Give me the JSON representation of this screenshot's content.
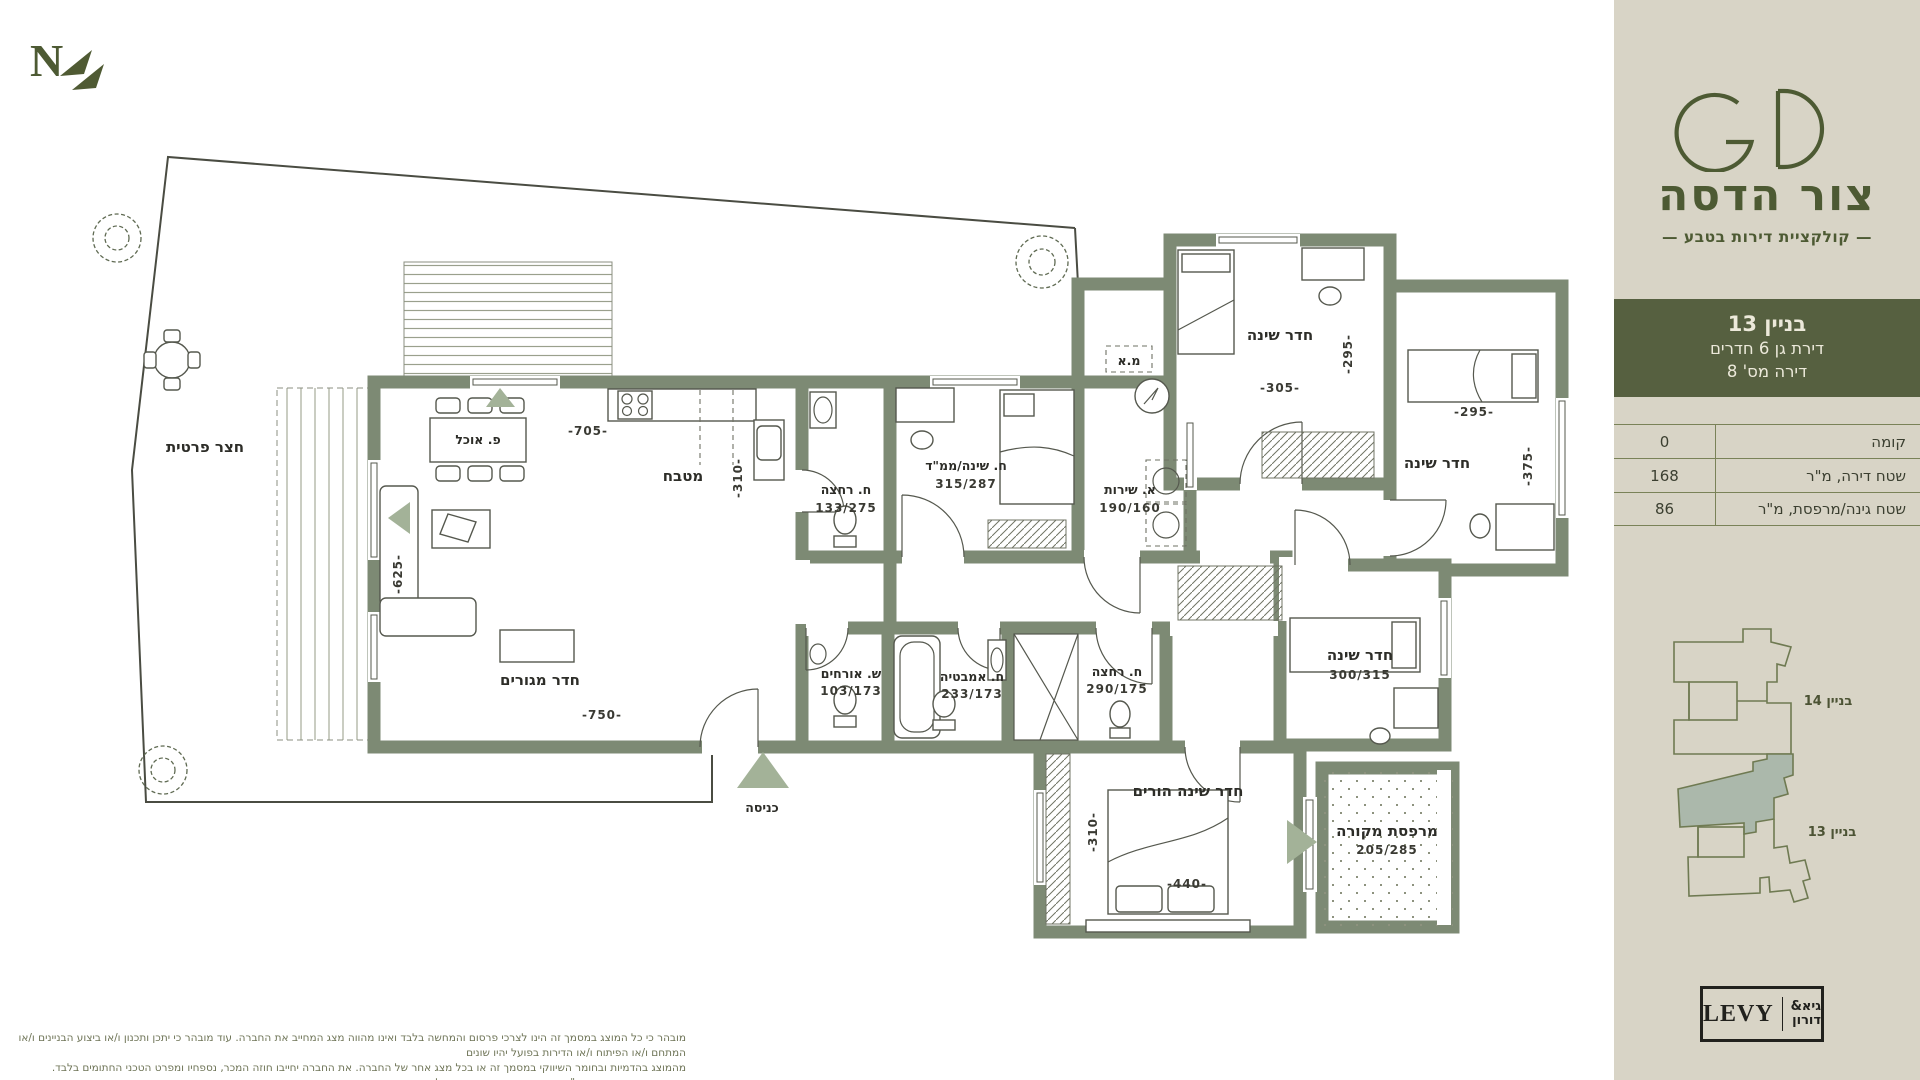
{
  "brand": {
    "logo": "GD",
    "title": "צור הדסה",
    "subtitle": "— קולקציית דירות בטבע —"
  },
  "unit": {
    "building": "בניין 13",
    "type": "דירת גן 6 חדרים",
    "number": "דירה מס' 8"
  },
  "specs": {
    "rows": [
      {
        "label": "קומה",
        "value": "0"
      },
      {
        "label": "שטח דירה, מ\"ר",
        "value": "168"
      },
      {
        "label": "שטח גינה/מרפסת, מ\"ר",
        "value": "86"
      }
    ]
  },
  "siteplan": {
    "building14": "בניין 14",
    "building13": "בניין 13"
  },
  "developer": {
    "name": "LEVY",
    "heb_top": "גיא&",
    "heb_bottom": "דורון"
  },
  "disclaimer": {
    "line1": "מובהר כי כל המוצג במסמך זה הינו לצרכי פרסום והמחשה בלבד ואינו מהווה מצג המחייב את החברה. עוד מובהר כי יתכן ותכנון ו/או ביצוע הבניינים ו/או המתחם ו/או הפיתוח ו/או הדירות בפועל יהיו שונים",
    "line2": "מהמוצג בהדמיות ובחומר השיווקי במסמך זה או בכל מצג אחר של החברה. את החברה יחייבו חוזה המכר, נספחיו ומפרט הטכני החתומים בלבד. השטחים המוצגים הינם ע\"פ חישוב חוק המכר דירות. ט.ל.ח."
  },
  "plan": {
    "north": "N",
    "labels": {
      "yard": "חצר פרטית",
      "dining": "פ. אוכל",
      "kitchen": "מטבח",
      "kitchen_w": "-705-",
      "kitchen_d": "-310-",
      "living": "חדר מגורים",
      "living_w": "-750-",
      "living_d": "-625-",
      "entrance": "כניסה",
      "bath1": "ח. רחצה",
      "bath1_dim": "133/275",
      "mamad": "ח. שינה/ממ\"ד",
      "mamad_dim": "315/287",
      "utility": "א. שירות",
      "utility_dim": "190/160",
      "ma": "מ.א",
      "bed1": "חדר שינה",
      "bed1_w": "-305-",
      "bed1_d": "-295-",
      "bed2": "חדר שינה",
      "bed2_w": "-295-",
      "bed2_d": "-375-",
      "bed3": "חדר שינה",
      "bed3_dim": "300/315",
      "guest": "ש. אורחים",
      "guest_dim": "103/173",
      "bath2": "ח. אמבטיה",
      "bath2_dim": "233/173",
      "shower": "ח. רחצה",
      "shower_dim": "290/175",
      "master": "חדר שינה הורים",
      "master_w": "-440-",
      "master_d": "-310-",
      "terrace": "מרפסת מקורה",
      "terrace_dim": "205/285"
    }
  }
}
